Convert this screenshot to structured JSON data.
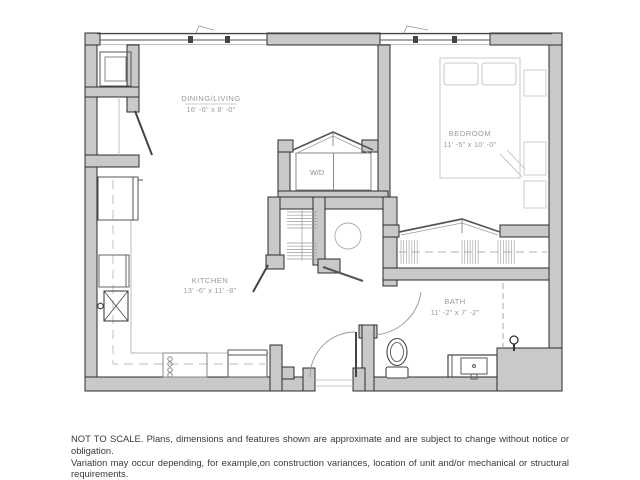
{
  "plan": {
    "rooms": [
      {
        "name": "DINING/LIVING",
        "dims": "16' -6\" x 8' -0\""
      },
      {
        "name": "BEDROOM",
        "dims": "11' -5\" x 10' -0\""
      },
      {
        "name": "KITCHEN",
        "dims": "13' -6\" x 11' -8\""
      },
      {
        "name": "BATH",
        "dims": "11' -2\" x 7' -2\""
      }
    ],
    "labels": {
      "washer_dryer": "W/D"
    },
    "colors": {
      "wall_fill": "#c9c9c9",
      "wall_stroke": "#2b2b2b",
      "fixture_stroke": "#555555",
      "furniture_light": "#c9c9c9",
      "label_text": "#9a9a9a"
    }
  },
  "disclaimer": {
    "line1": "NOT TO SCALE. Plans, dimensions and features shown are approximate and are subject to change without notice or obligation.",
    "line2": "Variation may occur depending, for example,on construction variances, location of unit and/or mechanical or structural requirements."
  }
}
